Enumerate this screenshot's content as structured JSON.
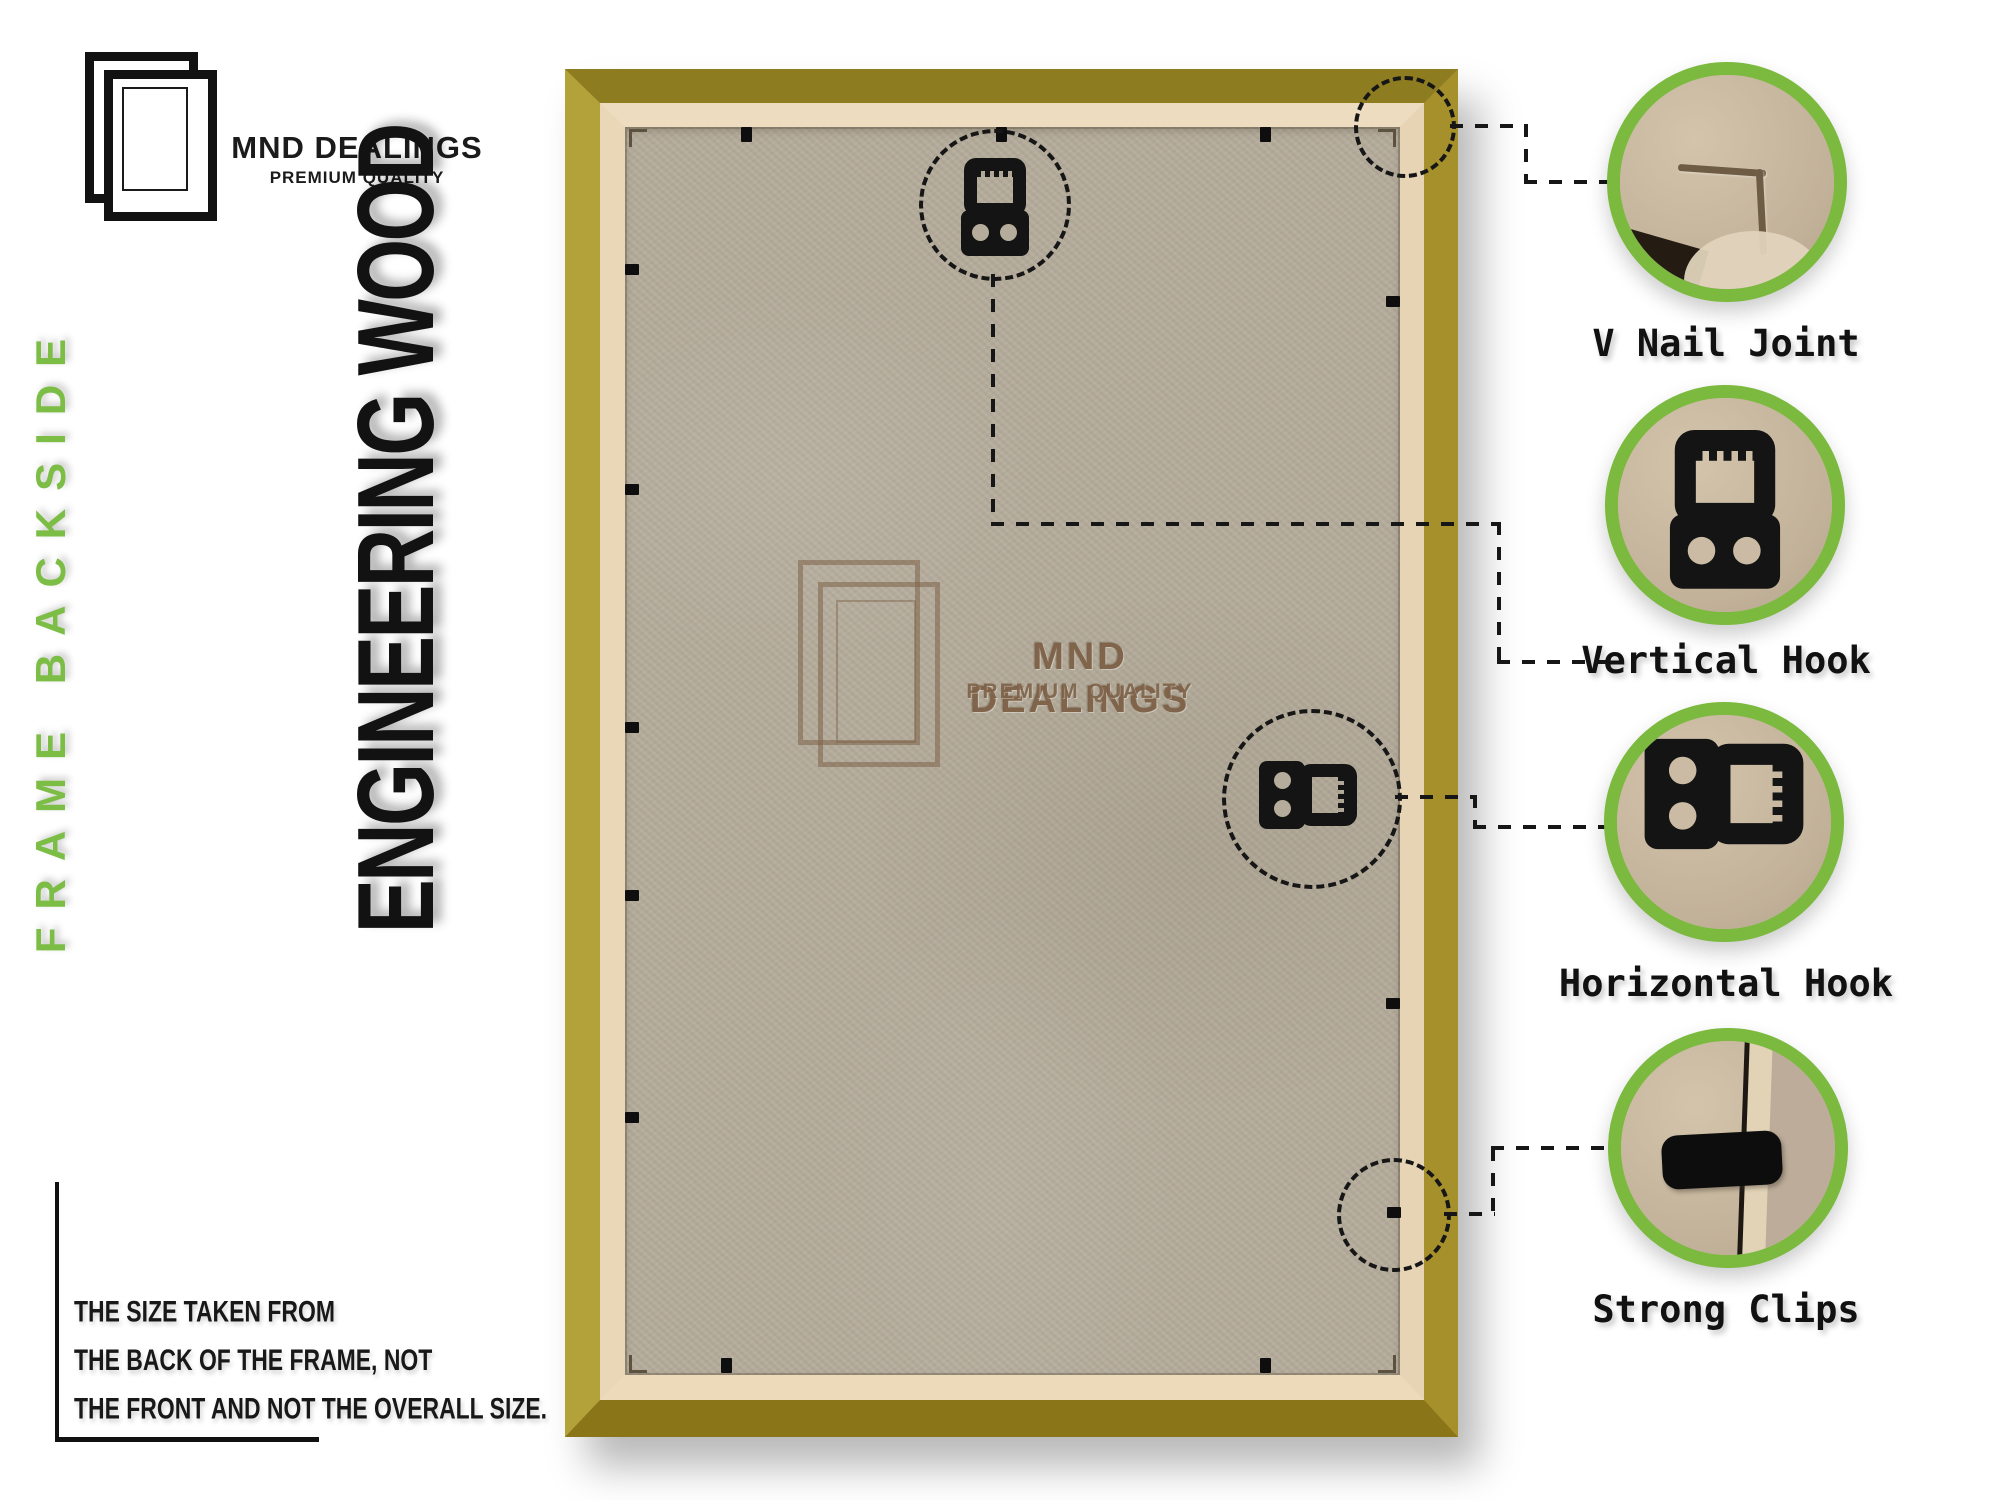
{
  "brand": {
    "name": "MND DEALINGS",
    "tagline": "PREMIUM QUALITY"
  },
  "side_text": {
    "frame_backside": "FRAME BACKSIDE",
    "engineering_wood": "ENGINEERING WOOD"
  },
  "watermark": {
    "name": "MND DEALINGS",
    "tagline": "PREMIUM QUALITY"
  },
  "note": {
    "line1": "THE SIZE TAKEN FROM",
    "line2": "THE BACK OF THE FRAME, NOT",
    "line3": "THE FRONT AND NOT THE OVERALL SIZE."
  },
  "callouts": [
    {
      "label": "V Nail Joint"
    },
    {
      "label": "Vertical Hook"
    },
    {
      "label": "Horizontal Hook"
    },
    {
      "label": "Strong Clips"
    }
  ],
  "colors": {
    "accent_green": "#7cb93f",
    "gold_light": "#b3a239",
    "gold_dark": "#8a7518",
    "cream_lip": "#e9d7b8",
    "mdf_board": "#b5ac9b",
    "annotation_black": "#161616"
  }
}
